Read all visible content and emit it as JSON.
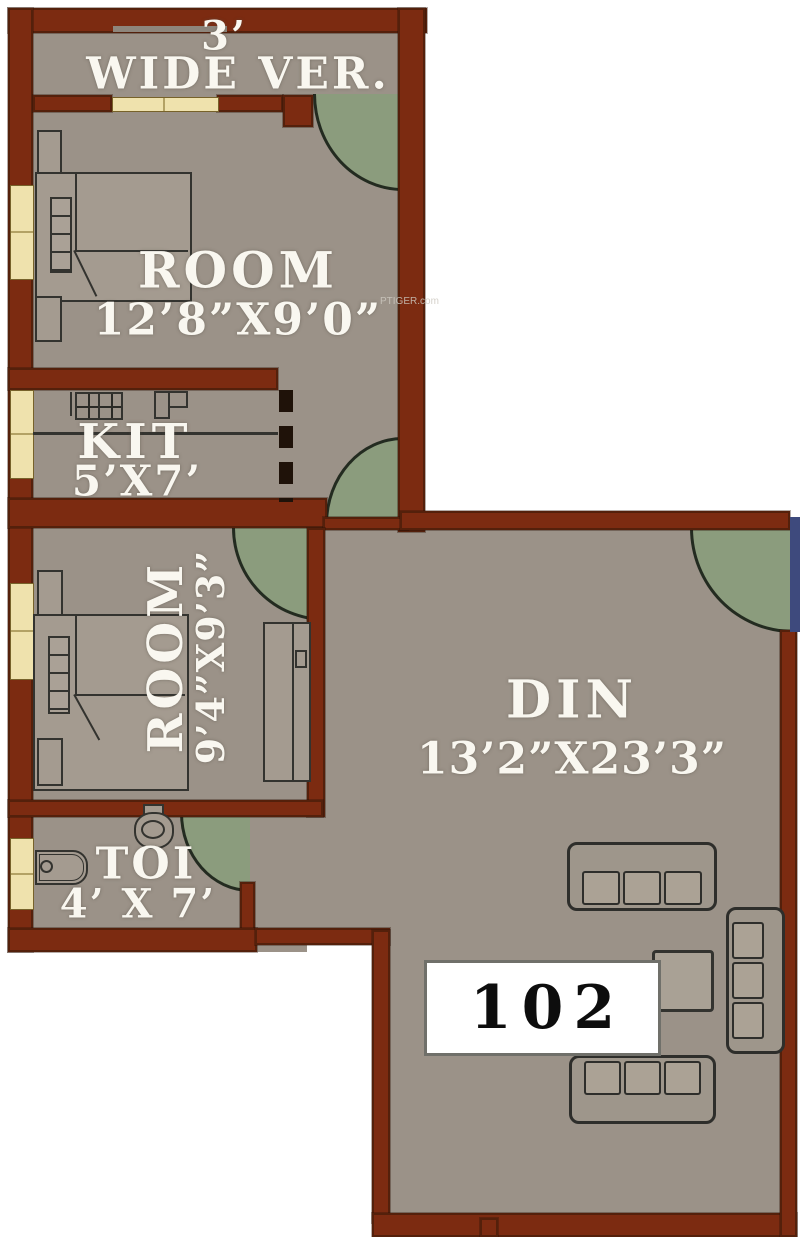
{
  "title": "Apartment floor plan",
  "unit": {
    "number": "102"
  },
  "watermark": "PTIGER.com",
  "rooms": {
    "veranda": {
      "width": "3’",
      "label": "WIDE VER."
    },
    "room1": {
      "label": "ROOM",
      "dims": "12’8”X9’0”"
    },
    "kitchen": {
      "label": "KIT",
      "dims": "5’X7’"
    },
    "room2": {
      "label": "ROOM",
      "dims": "9’4”X9’3”"
    },
    "toilet": {
      "label": "TOI",
      "dims": "4’ X 7’"
    },
    "dining": {
      "label": "DIN",
      "dims": "13’2”X23’3”"
    }
  },
  "colors": {
    "wall": "#7c2b11",
    "floor": "#9b9288",
    "door_swing": "#8b9c7d",
    "window": "#efe2ad",
    "adjacent_blue": "#3e4a7d",
    "background": "#ffffff"
  }
}
